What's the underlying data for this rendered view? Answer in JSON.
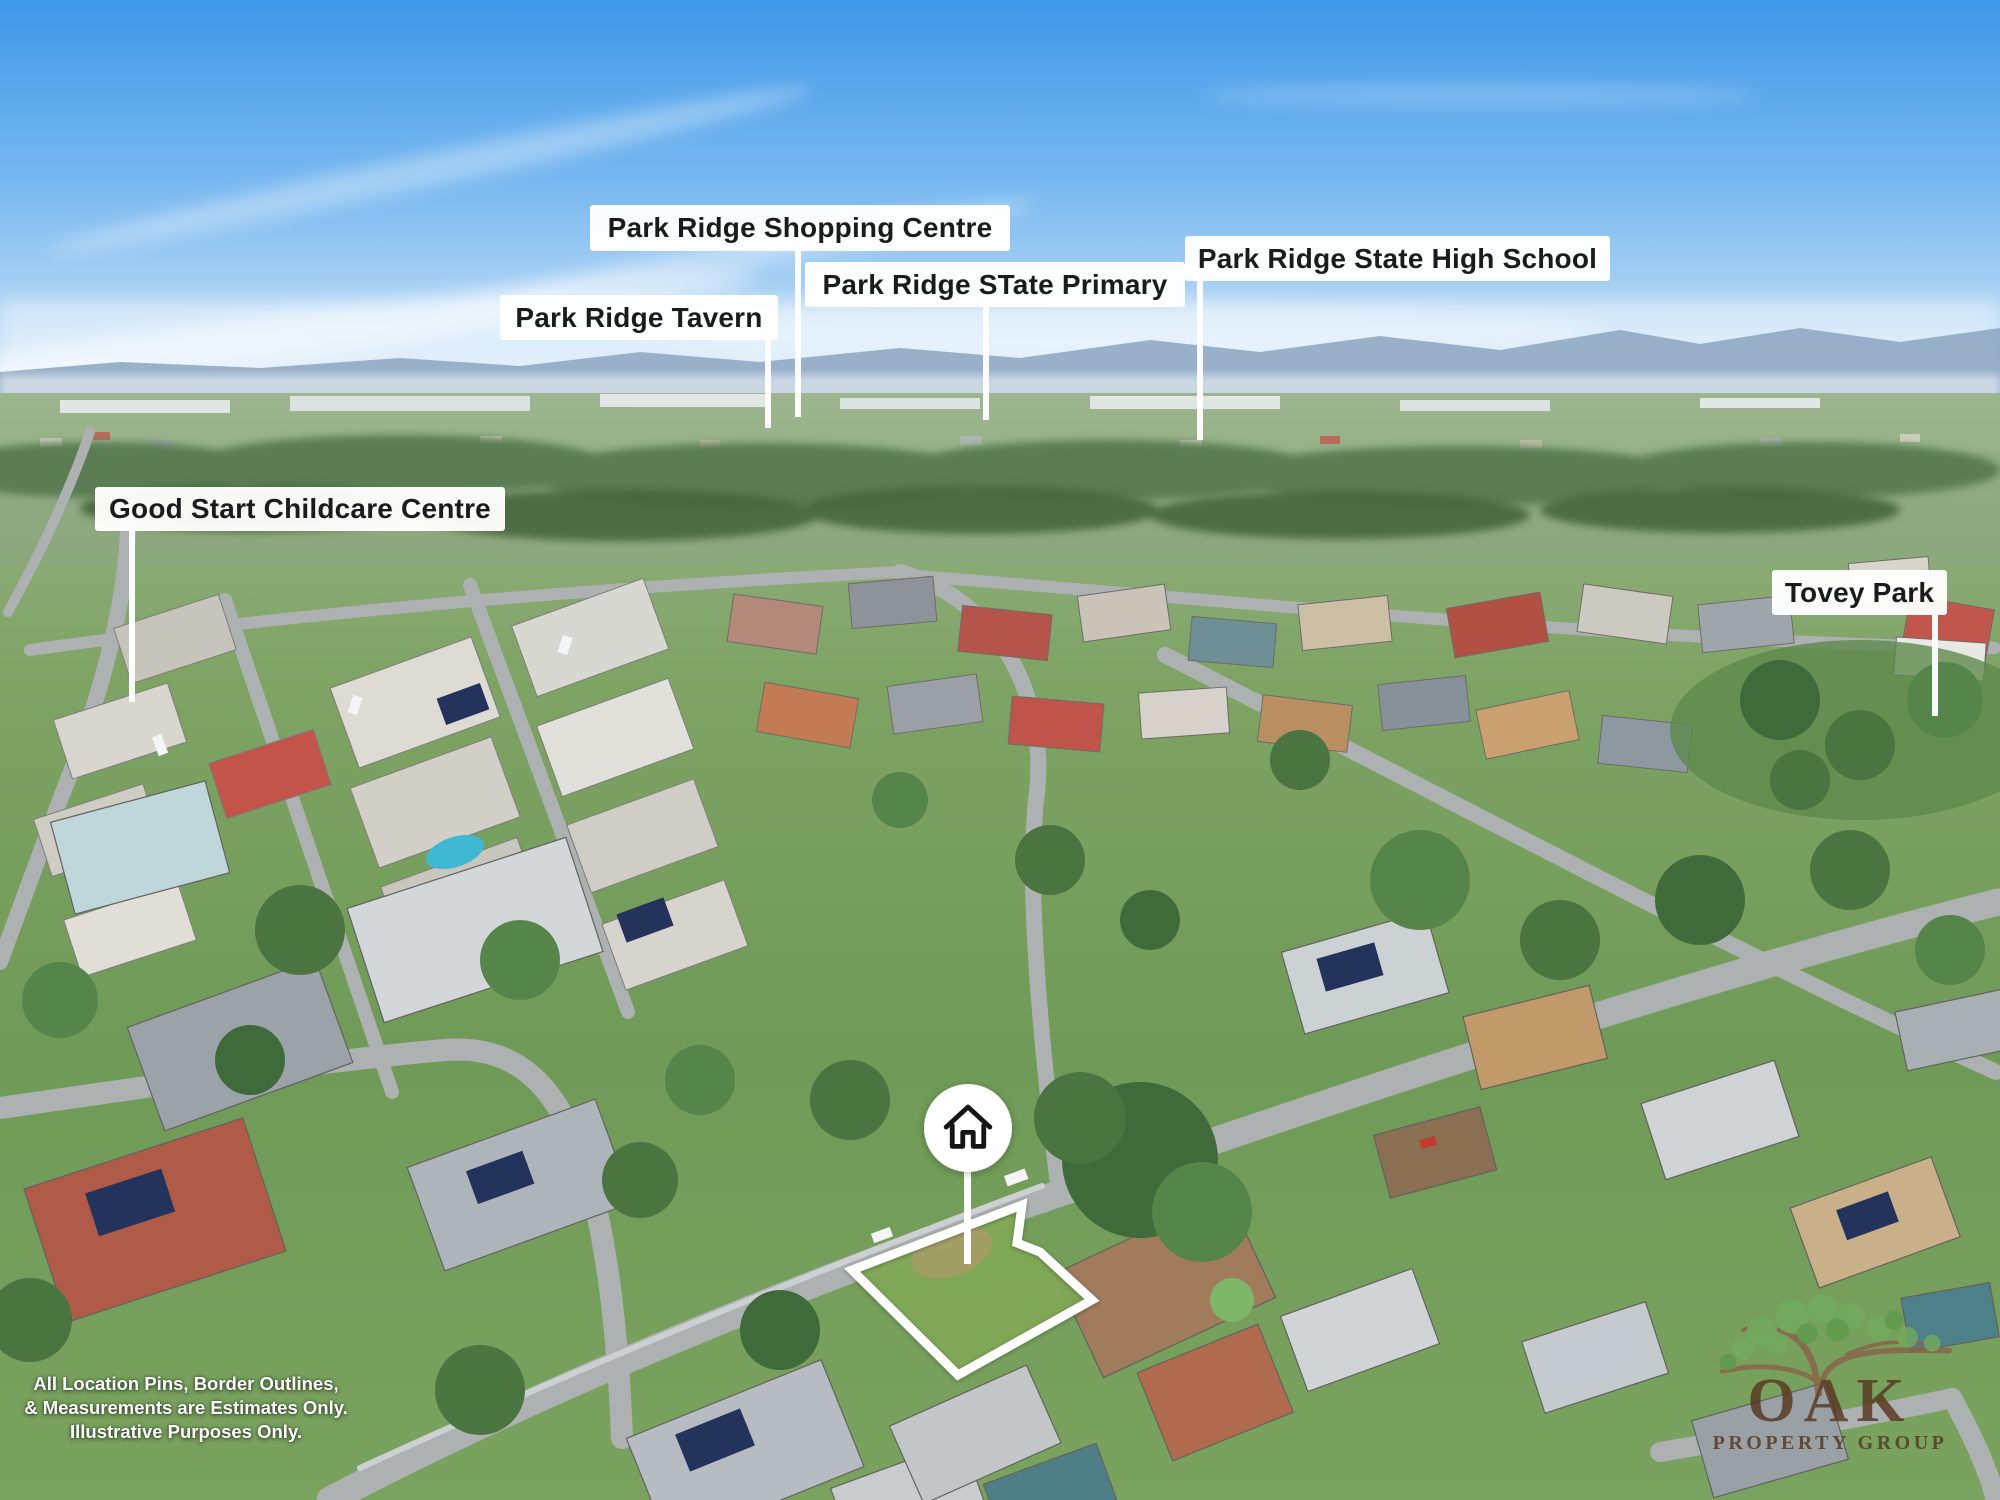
{
  "labels": {
    "shopping_centre": "Park Ridge Shopping Centre",
    "tavern": "Park Ridge Tavern",
    "state_primary": "Park Ridge STate Primary",
    "high_school": "Park Ridge State High School",
    "childcare": "Good Start Childcare Centre",
    "tovey_park": "Tovey Park"
  },
  "pin": {
    "icon": "house-icon"
  },
  "disclaimer": {
    "line1": "All Location Pins, Border Outlines,",
    "line2": "& Measurements are Estimates Only.",
    "line3": "Illustrative Purposes Only."
  },
  "logo": {
    "wordmark": "OAK",
    "subtitle": "PROPERTY GROUP",
    "icon": "oak-tree-icon"
  },
  "colors": {
    "label_background": "#ffffff",
    "label_text": "#1b1b1d",
    "pin_background": "#ffffff",
    "pin_icon": "#151515",
    "boundary_line": "#ffffff",
    "stem_line": "#ffffff",
    "disclaimer_text": "#ffffff",
    "logo_text": "#57371f",
    "logo_leaves": "#74ad5f",
    "logo_branches": "#8a6248",
    "sky_top": "#3e98e9",
    "grass": "#6f9a57"
  }
}
